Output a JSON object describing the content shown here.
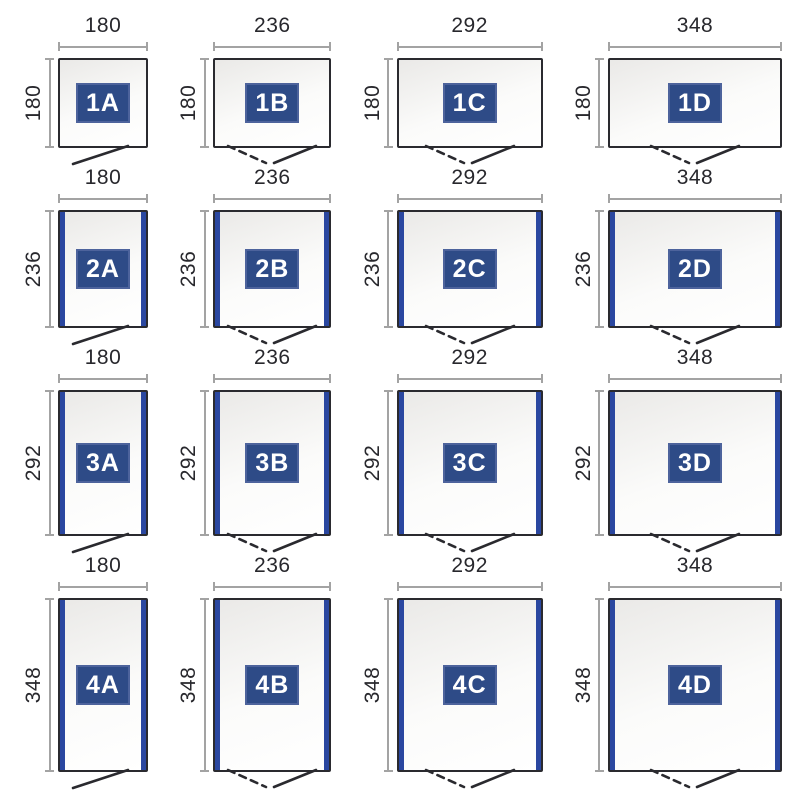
{
  "palette": {
    "badge_blue": "#2e4b87",
    "badge_border": "#4d639c",
    "strip_blue": "#2a47a0",
    "outline_dark": "#2a2a2f",
    "dim_line_gray": "#a3a3a3",
    "dim_text": "#28282d",
    "box_fill_top": "#eae9e7",
    "box_fill_bottom": "#fbfbfa"
  },
  "grid": {
    "columns": [
      "A",
      "B",
      "C",
      "D"
    ],
    "rows": [
      "1",
      "2",
      "3",
      "4"
    ],
    "column_widths": [
      180,
      236,
      292,
      348
    ],
    "row_heights": [
      180,
      236,
      292,
      348
    ],
    "cells": [
      {
        "id": "1A",
        "label": "1A",
        "width": 180,
        "height": 180,
        "width_label": "180",
        "height_label": "180",
        "door": "single",
        "side_panels": false
      },
      {
        "id": "1B",
        "label": "1B",
        "width": 236,
        "height": 180,
        "width_label": "236",
        "height_label": "180",
        "door": "double",
        "side_panels": false
      },
      {
        "id": "1C",
        "label": "1C",
        "width": 292,
        "height": 180,
        "width_label": "292",
        "height_label": "180",
        "door": "double",
        "side_panels": false
      },
      {
        "id": "1D",
        "label": "1D",
        "width": 348,
        "height": 180,
        "width_label": "348",
        "height_label": "180",
        "door": "double",
        "side_panels": false
      },
      {
        "id": "2A",
        "label": "2A",
        "width": 180,
        "height": 236,
        "width_label": "180",
        "height_label": "236",
        "door": "single",
        "side_panels": true
      },
      {
        "id": "2B",
        "label": "2B",
        "width": 236,
        "height": 236,
        "width_label": "236",
        "height_label": "236",
        "door": "double",
        "side_panels": true
      },
      {
        "id": "2C",
        "label": "2C",
        "width": 292,
        "height": 236,
        "width_label": "292",
        "height_label": "236",
        "door": "double",
        "side_panels": true
      },
      {
        "id": "2D",
        "label": "2D",
        "width": 348,
        "height": 236,
        "width_label": "348",
        "height_label": "236",
        "door": "double",
        "side_panels": true
      },
      {
        "id": "3A",
        "label": "3A",
        "width": 180,
        "height": 292,
        "width_label": "180",
        "height_label": "292",
        "door": "single",
        "side_panels": true
      },
      {
        "id": "3B",
        "label": "3B",
        "width": 236,
        "height": 292,
        "width_label": "236",
        "height_label": "292",
        "door": "double",
        "side_panels": true
      },
      {
        "id": "3C",
        "label": "3C",
        "width": 292,
        "height": 292,
        "width_label": "292",
        "height_label": "292",
        "door": "double",
        "side_panels": true
      },
      {
        "id": "3D",
        "label": "3D",
        "width": 348,
        "height": 292,
        "width_label": "348",
        "height_label": "292",
        "door": "double",
        "side_panels": true
      },
      {
        "id": "4A",
        "label": "4A",
        "width": 180,
        "height": 348,
        "width_label": "180",
        "height_label": "348",
        "door": "single",
        "side_panels": true
      },
      {
        "id": "4B",
        "label": "4B",
        "width": 236,
        "height": 348,
        "width_label": "236",
        "height_label": "348",
        "door": "double",
        "side_panels": true
      },
      {
        "id": "4C",
        "label": "4C",
        "width": 292,
        "height": 348,
        "width_label": "292",
        "height_label": "348",
        "door": "double",
        "side_panels": true
      },
      {
        "id": "4D",
        "label": "4D",
        "width": 348,
        "height": 348,
        "width_label": "348",
        "height_label": "348",
        "door": "double",
        "side_panels": true
      }
    ]
  }
}
